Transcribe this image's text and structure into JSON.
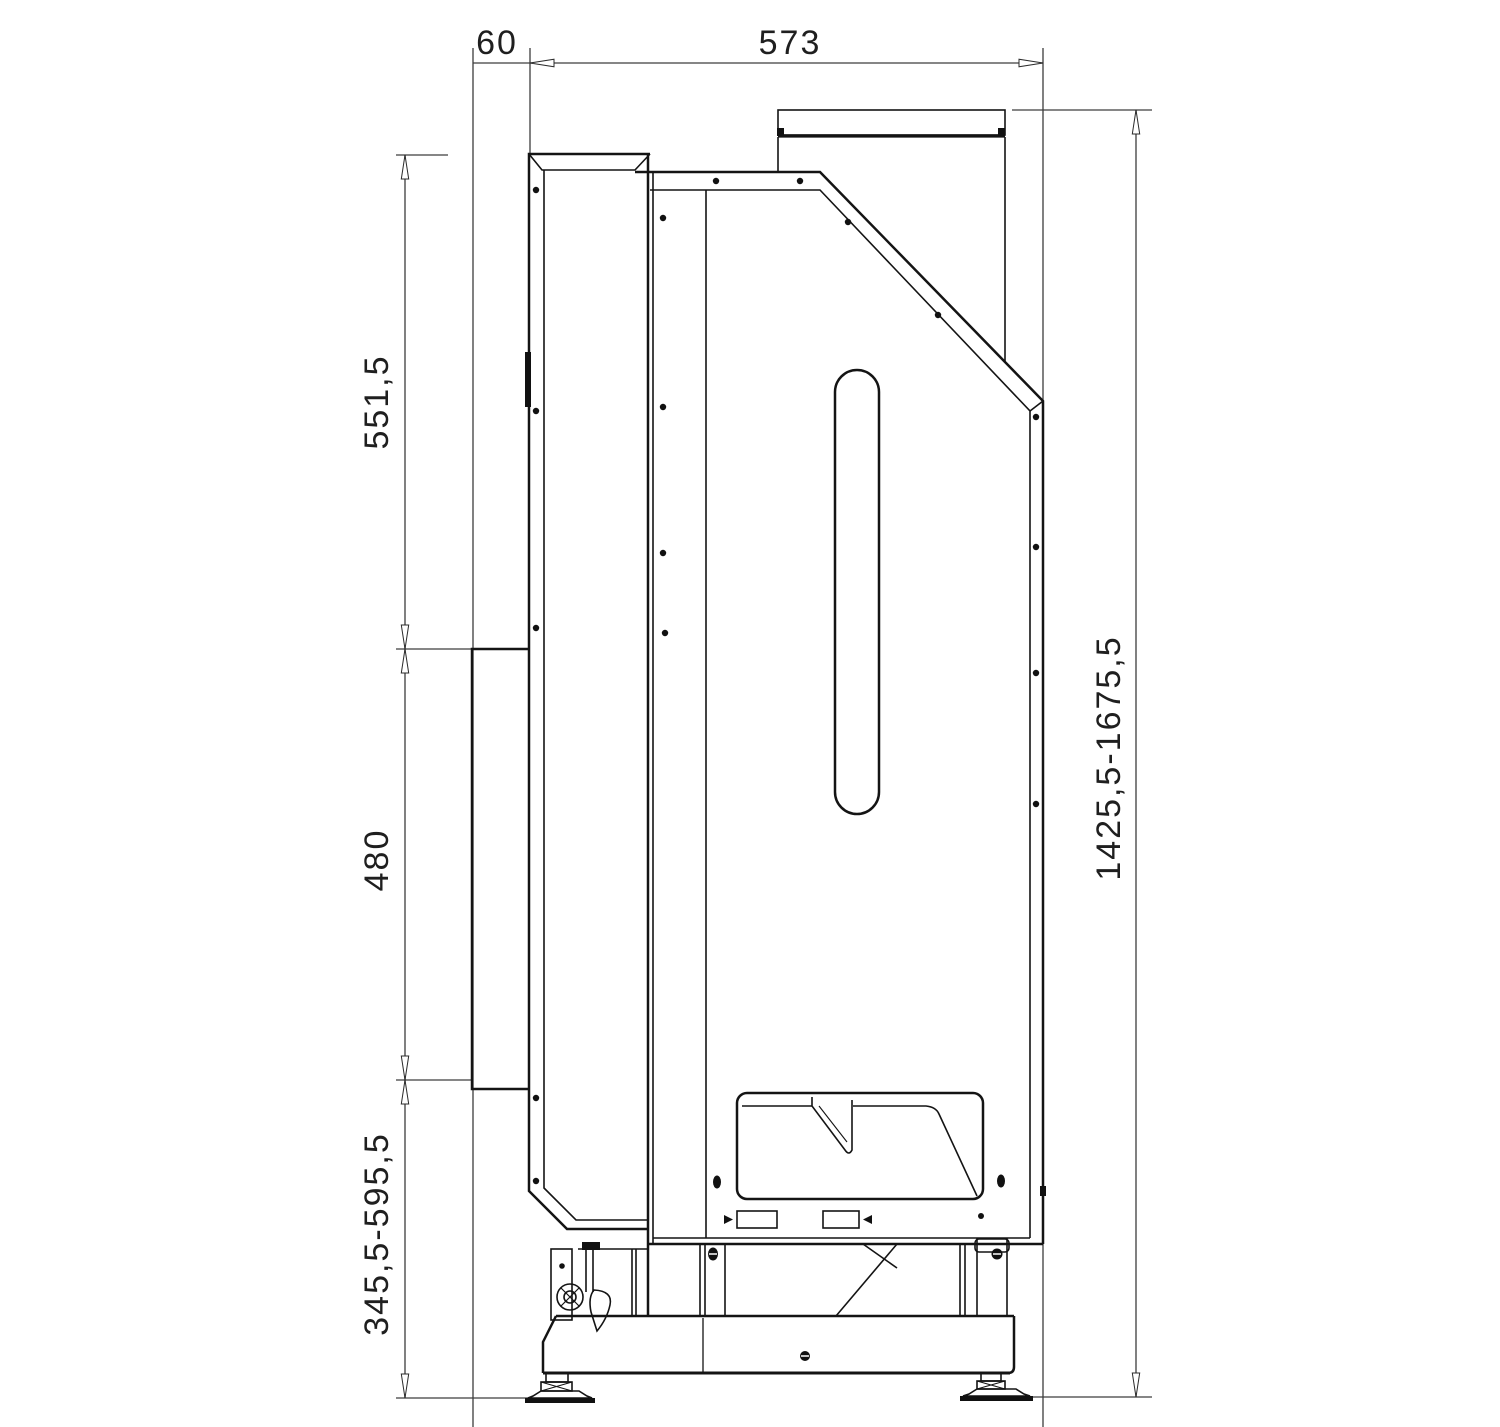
{
  "drawing": {
    "type": "technical-dimension-drawing",
    "view": "appliance side view with dimension chains",
    "colors": {
      "object_line": "#141414",
      "dimension_line": "#3d3d3d",
      "background": "#ffffff"
    },
    "dimensions": {
      "top_front_offset": "60",
      "top_depth": "573",
      "left_upper_height": "551,5",
      "left_door_height": "480",
      "left_lower_height": "345,5-595,5",
      "right_total_height": "1425,5-1675,5"
    }
  }
}
